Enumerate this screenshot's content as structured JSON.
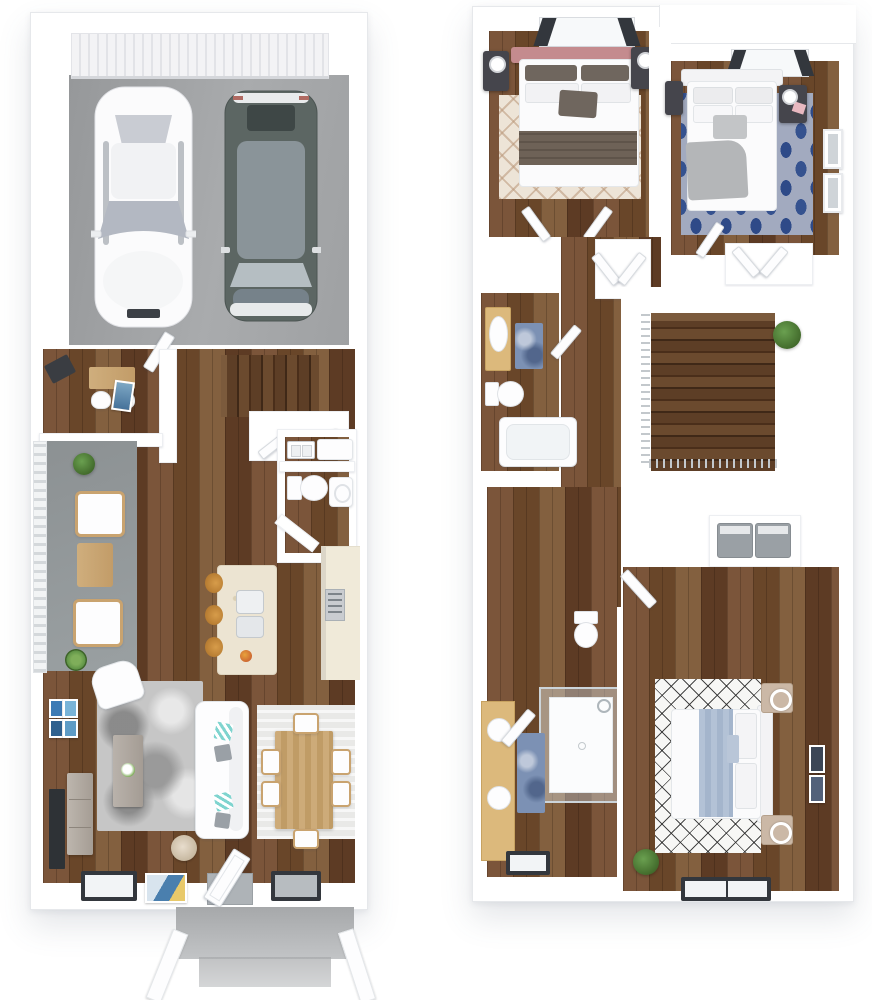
{
  "scene": {
    "title": "Two-story townhome 3D floor plan, top-down dollhouse view",
    "floor_count": 2,
    "style": "photoreal 3D render, white walls, dark hardwood floors"
  },
  "floor1": {
    "label": "First floor",
    "rooms": {
      "garage": {
        "label": "2-car garage",
        "floor": "concrete",
        "objects": [
          "garage-door",
          "white-sedan",
          "gray-suv"
        ]
      },
      "entry_nook": {
        "label": "Entry desk nook",
        "objects": [
          "desk",
          "two-chairs",
          "art-print",
          "corner-speaker"
        ]
      },
      "laundry": {
        "label": "Laundry closet",
        "objects": [
          "utility-sink",
          "washer"
        ]
      },
      "powder_room": {
        "label": "Powder room",
        "objects": [
          "toilet",
          "corner-sink",
          "angled-wall"
        ]
      },
      "stairs": {
        "label": "Staircase up",
        "objects": [
          "under-stair-closet",
          "chaise-bench"
        ]
      },
      "kitchen": {
        "label": "Kitchen",
        "objects": [
          "wall-counter",
          "range",
          "island-with-sink",
          "three-stools",
          "fruit-bowl"
        ]
      },
      "patio": {
        "label": "Side patio",
        "objects": [
          "railing",
          "two-lounge-chairs",
          "coffee-table",
          "potted-plant",
          "spiky-plant"
        ]
      },
      "living": {
        "label": "Living room",
        "objects": [
          "sofa-with-teal-pillows",
          "armchair",
          "coffee-table-flowers",
          "floor-lamp",
          "tv",
          "media-cabinet",
          "gallery-art-4",
          "plant"
        ]
      },
      "dining": {
        "label": "Dining area",
        "objects": [
          "table",
          "six-chairs",
          "striped-rug"
        ]
      },
      "porch": {
        "label": "Front porch",
        "objects": [
          "concrete-stoop",
          "two-rails",
          "front-door",
          "two-windows",
          "door-mat-art"
        ]
      }
    }
  },
  "floor2": {
    "label": "Second floor",
    "rooms": {
      "bedroom2": {
        "label": "Bedroom 2",
        "objects": [
          "bed-pink-headboard",
          "two-dark-nightstands",
          "lamps",
          "trellis-rug",
          "skylight-window"
        ]
      },
      "bedroom3": {
        "label": "Bedroom 3",
        "objects": [
          "bed-white-headboard",
          "gray-throw",
          "dark-nightstands",
          "blue-ogee-rug",
          "wall-windows",
          "skylight-window"
        ]
      },
      "hall_bath": {
        "label": "Hall bathroom",
        "objects": [
          "vanity",
          "toilet",
          "tub",
          "blue-rug"
        ]
      },
      "hallway": {
        "label": "Hallway"
      },
      "stairwell": {
        "label": "Stairwell down",
        "objects": [
          "chrome-railing",
          "plant"
        ]
      },
      "closets": {
        "label": "Linen / hall closets",
        "objects": [
          "angled-doors"
        ]
      },
      "laundry2": {
        "label": "Laundry closet",
        "objects": [
          "washer",
          "dryer"
        ]
      },
      "master_bath": {
        "label": "Primary bathroom",
        "objects": [
          "double-vanity",
          "two-round-sinks",
          "glass-shower",
          "toilet",
          "blue-rug",
          "window"
        ]
      },
      "master_bed": {
        "label": "Primary bedroom",
        "objects": [
          "bed-blue-runner",
          "diamond-rug",
          "two-light-nightstands",
          "ring-lamps",
          "art-frames",
          "window",
          "plant"
        ]
      }
    }
  },
  "colors": {
    "wall": "#ffffff",
    "wall_edge": "#e6e8eb",
    "wood_floor": "#6c4830",
    "stair_wood": "#53361f",
    "garage_concrete": "#9d9fa1",
    "patio_concrete": "#8f9496",
    "porch_concrete": "#a8aaac",
    "counter_cream": "#f0ead9",
    "vanity_tan": "#dcb97c",
    "rug_gray": "#c6c6c6",
    "rug_trellis": "#ede4d7",
    "rug_ogee_blue": "#2e4a88",
    "rug_diamond": "#f7f7f5",
    "headboard_pink": "#c48b8e",
    "blanket_dark": "#6b6158",
    "blanket_gray": "#b4b6b8",
    "runner_blue": "#b3c2d6",
    "pillow_teal": "#7fd4cf",
    "nightstand_dark": "#45454c",
    "suv_body": "#5c6663",
    "art_blue": "#3d7bb5",
    "plant_green": "#46702f",
    "chrome": "#c3c8cc"
  }
}
